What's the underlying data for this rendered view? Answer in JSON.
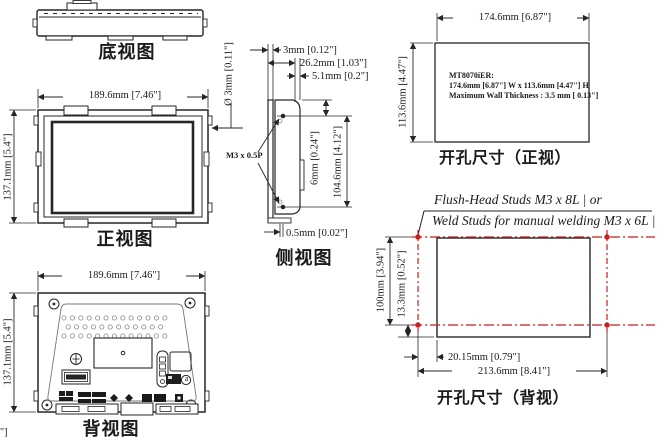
{
  "title": "MT8070iER installation dimension drawing",
  "colors": {
    "line": "#262626",
    "red": "#c81e1e"
  },
  "views": {
    "bottom_view": {
      "label": "底视图"
    },
    "front_view": {
      "label": "正视图",
      "width": "189.6mm [7.46\"]",
      "height": "137.1mm [5.4\"]",
      "hole": "Ø 3mm [0.11\"]"
    },
    "side_view": {
      "label": "侧视图",
      "thread": "M3 x 0.5P",
      "front_bezel": "3mm [0.12\"]",
      "overall_depth": "26.2mm [1.03\"]",
      "rear_depth": "5.1mm [0.2\"]",
      "stud_offset": "6mm [0.24\"]",
      "stud_span": "104.6mm [4.12\"]",
      "front_lip": "0.5mm [0.02\"]"
    },
    "back_view": {
      "label": "背视图",
      "width": "189.6mm [7.46\"]",
      "height": "137.1mm [5.4\"]",
      "callout_a": "a"
    },
    "cutout_front": {
      "label": "开孔尺寸（正视）",
      "width": "174.6mm [6.87\"]",
      "height": "113.6mm [4.47\"]",
      "note1": "MT8070iER:",
      "note2": "174.6mm [6.87\"] W x 113.6mm [4.47\"] H",
      "note3": "Maximum Wall Thickness : 3.5 mm [ 0.13\"]"
    },
    "cutout_back": {
      "label": "开孔尺寸（背视）",
      "note1": "Flush-Head Studs M3 x 8L | or",
      "note2": "Weld Studs for manual welding M3 x 6L |",
      "stud_span_v": "100mm [3.94\"]",
      "offset_v": "13.3mm [0.52\"]",
      "offset_h": "20.15mm [0.79\"]",
      "stud_span_h": "213.6mm [8.41\"]"
    }
  },
  "artifact": "\"]"
}
